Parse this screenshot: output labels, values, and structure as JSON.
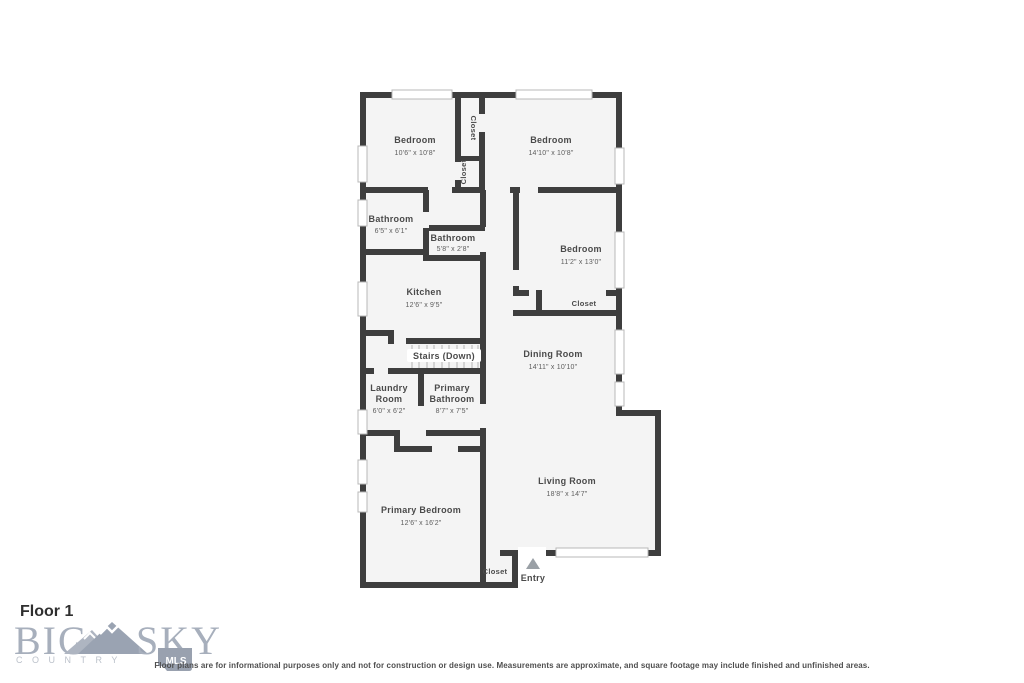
{
  "floor": {
    "label": "Floor 1"
  },
  "rooms": {
    "bedroom_top_left": {
      "name": "Bedroom",
      "dims": "10'6\" x 10'8\""
    },
    "bedroom_top_right": {
      "name": "Bedroom",
      "dims": "14'10\" x 10'8\""
    },
    "closet_upper": {
      "name": "Closet"
    },
    "closet_middle": {
      "name": "Closet"
    },
    "bathroom_hall": {
      "name": "Bathroom",
      "dims": "6'5\" x 6'1\""
    },
    "bathroom_small": {
      "name": "Bathroom",
      "dims": "5'8\" x 2'8\""
    },
    "bedroom_right": {
      "name": "Bedroom",
      "dims": "11'2\" x 13'0\""
    },
    "kitchen": {
      "name": "Kitchen",
      "dims": "12'6\" x 9'5\""
    },
    "closet_bedroom_right": {
      "name": "Closet"
    },
    "stairs": {
      "name": "Stairs (Down)"
    },
    "dining_room": {
      "name": "Dining Room",
      "dims": "14'11\" x 10'10\""
    },
    "laundry_room": {
      "line1": "Laundry",
      "line2": "Room",
      "dims": "6'0\" x 6'2\""
    },
    "primary_bathroom": {
      "line1": "Primary",
      "line2": "Bathroom",
      "dims": "8'7\" x 7'5\""
    },
    "living_room": {
      "name": "Living Room",
      "dims": "18'8\" x 14'7\""
    },
    "primary_bedroom": {
      "name": "Primary Bedroom",
      "dims": "12'6\" x 16'2\""
    },
    "closet_entry": {
      "name": "Closet"
    },
    "entry": {
      "name": "Entry"
    }
  },
  "logo": {
    "word_left": "BIG",
    "word_right": "SKY",
    "tagline": "COUNTRY",
    "badge": "MLS"
  },
  "footer": {
    "disclaimer": "Floor plans are for informational purposes only and not for construction or design use. Measurements are approximate, and square footage may include finished and unfinished areas."
  },
  "colors": {
    "wall": "#3e3e3e",
    "room_fill": "#f4f4f4",
    "label_text": "#4a4a4a",
    "logo": "#a7afbc",
    "window_frame": "#b8b8b8",
    "arrow": "#9aa0a6"
  }
}
